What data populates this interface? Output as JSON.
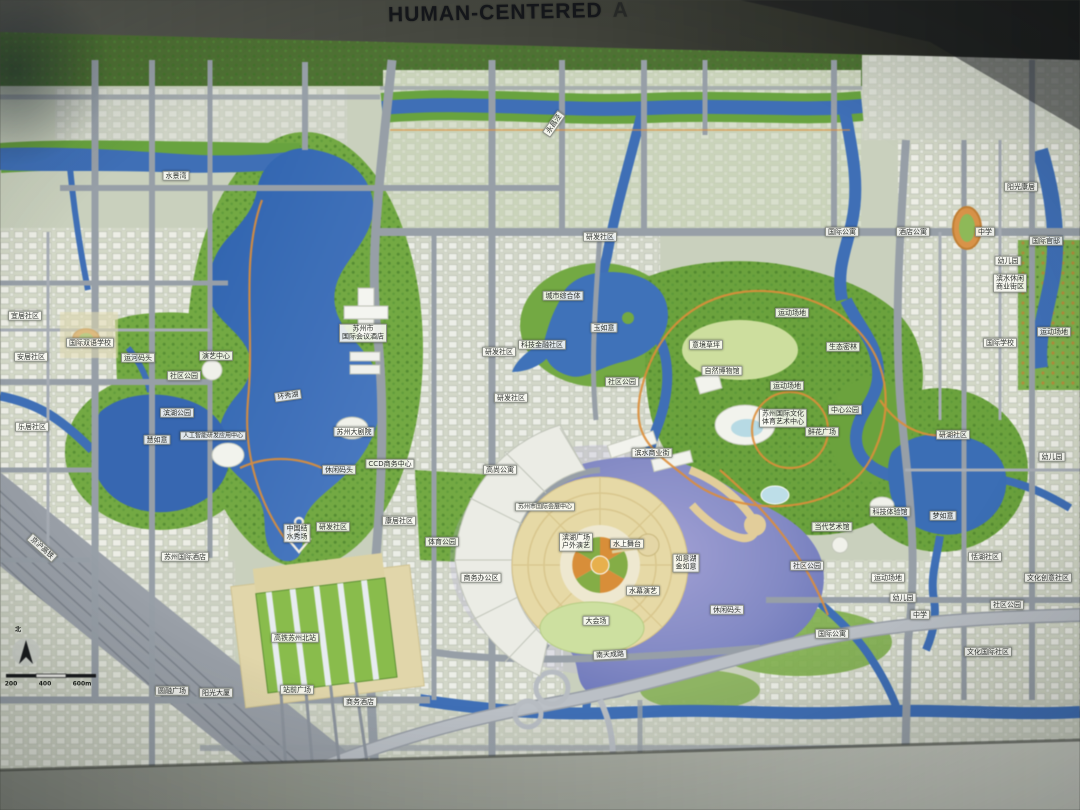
{
  "header": {
    "title_main": "HUMAN-CENTERED",
    "title_fragment": "A"
  },
  "map": {
    "compass": {
      "north_label": "北"
    },
    "scale_bar": {
      "ticks": [
        "200",
        "400",
        "600m"
      ]
    },
    "lakes": [
      "环秀湖",
      "玉如意",
      "如意湖 金如意",
      "梦如意",
      "慧如意",
      "水景湾"
    ],
    "labels": [
      {
        "t": "水景湾",
        "x": 176,
        "y": 176
      },
      {
        "t": "永昌泾",
        "x": 554,
        "y": 124,
        "r": -55
      },
      {
        "t": "研发社区",
        "x": 600,
        "y": 237
      },
      {
        "t": "城市综合体",
        "x": 563,
        "y": 296
      },
      {
        "t": "玉如意",
        "x": 604,
        "y": 328
      },
      {
        "t": "科技金融社区",
        "x": 542,
        "y": 345
      },
      {
        "t": "研发社区",
        "x": 499,
        "y": 352
      },
      {
        "t": "研发社区",
        "x": 511,
        "y": 398
      },
      {
        "t": "社区公园",
        "x": 622,
        "y": 382
      },
      {
        "t": "滨水商业街",
        "x": 652,
        "y": 453
      },
      {
        "t": "意境草坪",
        "x": 706,
        "y": 345
      },
      {
        "t": "自然博物馆",
        "x": 722,
        "y": 371
      },
      {
        "t": "运动场地",
        "x": 792,
        "y": 313
      },
      {
        "t": "生态密林",
        "x": 843,
        "y": 347
      },
      {
        "t": "运动场地",
        "x": 787,
        "y": 386
      },
      {
        "t": "苏州国际文化\n体育艺术中心",
        "x": 783,
        "y": 418
      },
      {
        "t": "中心公园",
        "x": 845,
        "y": 410
      },
      {
        "t": "鲜花广场",
        "x": 822,
        "y": 432
      },
      {
        "t": "苏州市\n国际会议酒店",
        "x": 363,
        "y": 333
      },
      {
        "t": "环秀湖",
        "x": 288,
        "y": 396,
        "r": -8
      },
      {
        "t": "苏州大剧院",
        "x": 354,
        "y": 432
      },
      {
        "t": "CCD商务中心",
        "x": 390,
        "y": 464
      },
      {
        "t": "休闲码头",
        "x": 339,
        "y": 470
      },
      {
        "t": "研发社区",
        "x": 333,
        "y": 527
      },
      {
        "t": "苏州国际酒店",
        "x": 185,
        "y": 557
      },
      {
        "t": "中国结\n水秀场",
        "x": 297,
        "y": 533
      },
      {
        "t": "高铁苏州北站",
        "x": 295,
        "y": 638
      },
      {
        "t": "站前广场",
        "x": 297,
        "y": 690
      },
      {
        "t": "商务酒店",
        "x": 360,
        "y": 702
      },
      {
        "t": "圆融广场",
        "x": 172,
        "y": 691
      },
      {
        "t": "阳光大厦",
        "x": 216,
        "y": 693
      },
      {
        "t": "慧如意",
        "x": 157,
        "y": 440
      },
      {
        "t": "人工智能研发应用中心",
        "x": 213,
        "y": 436,
        "fs": 6
      },
      {
        "t": "滨湖公园",
        "x": 177,
        "y": 413
      },
      {
        "t": "社区公园",
        "x": 184,
        "y": 376
      },
      {
        "t": "运河码头",
        "x": 138,
        "y": 358
      },
      {
        "t": "演艺中心",
        "x": 216,
        "y": 356
      },
      {
        "t": "国际双语学校",
        "x": 90,
        "y": 343
      },
      {
        "t": "安居社区",
        "x": 31,
        "y": 357
      },
      {
        "t": "乐居社区",
        "x": 32,
        "y": 427
      },
      {
        "t": "宜居社区",
        "x": 25,
        "y": 316
      },
      {
        "t": "滨湖广场\n户外演艺",
        "x": 576,
        "y": 542
      },
      {
        "t": "水上舞台",
        "x": 627,
        "y": 544
      },
      {
        "t": "苏州市国际会展中心",
        "x": 545,
        "y": 507,
        "fs": 6
      },
      {
        "t": "如意湖\n金如意",
        "x": 686,
        "y": 563
      },
      {
        "t": "水幕演艺",
        "x": 643,
        "y": 591
      },
      {
        "t": "大会场",
        "x": 596,
        "y": 621
      },
      {
        "t": "休闲码头",
        "x": 727,
        "y": 610
      },
      {
        "t": "南天成路",
        "x": 610,
        "y": 655,
        "r": -3
      },
      {
        "t": "社区公园",
        "x": 807,
        "y": 566
      },
      {
        "t": "国际公寓",
        "x": 832,
        "y": 634
      },
      {
        "t": "幼儿园",
        "x": 903,
        "y": 598
      },
      {
        "t": "运动场地",
        "x": 888,
        "y": 578
      },
      {
        "t": "当代艺术馆",
        "x": 832,
        "y": 527
      },
      {
        "t": "科技体验馆",
        "x": 890,
        "y": 512
      },
      {
        "t": "梦如意",
        "x": 943,
        "y": 516
      },
      {
        "t": "研湖社区",
        "x": 953,
        "y": 435
      },
      {
        "t": "恬湖社区",
        "x": 985,
        "y": 557
      },
      {
        "t": "幼儿园",
        "x": 1052,
        "y": 457
      },
      {
        "t": "文化创意社区",
        "x": 1048,
        "y": 578
      },
      {
        "t": "社区公园",
        "x": 1007,
        "y": 605
      },
      {
        "t": "中学",
        "x": 920,
        "y": 615
      },
      {
        "t": "文化国际社区",
        "x": 988,
        "y": 652
      },
      {
        "t": "国际公寓",
        "x": 842,
        "y": 232
      },
      {
        "t": "酒店公寓",
        "x": 913,
        "y": 232
      },
      {
        "t": "阳光康居",
        "x": 1021,
        "y": 187
      },
      {
        "t": "中学",
        "x": 985,
        "y": 232
      },
      {
        "t": "幼儿园",
        "x": 1008,
        "y": 261
      },
      {
        "t": "国际官邸",
        "x": 1046,
        "y": 241
      },
      {
        "t": "滨水休闲\n商业街区",
        "x": 1010,
        "y": 283
      },
      {
        "t": "运动场地",
        "x": 1054,
        "y": 332
      },
      {
        "t": "国际学校",
        "x": 1000,
        "y": 343
      },
      {
        "t": "高尚公寓",
        "x": 500,
        "y": 470
      },
      {
        "t": "康居社区",
        "x": 399,
        "y": 521
      },
      {
        "t": "体育公园",
        "x": 442,
        "y": 542
      },
      {
        "t": "商务办公区",
        "x": 481,
        "y": 578
      },
      {
        "t": "京沪高铁",
        "x": 42,
        "y": 548,
        "r": 42
      },
      {
        "t": "北",
        "x": 18,
        "y": 630,
        "s": "plain"
      },
      {
        "t": "200",
        "x": 11,
        "y": 684,
        "s": "plain"
      },
      {
        "t": "400",
        "x": 45,
        "y": 684,
        "s": "plain"
      },
      {
        "t": "600m",
        "x": 82,
        "y": 684,
        "s": "plain"
      }
    ]
  }
}
